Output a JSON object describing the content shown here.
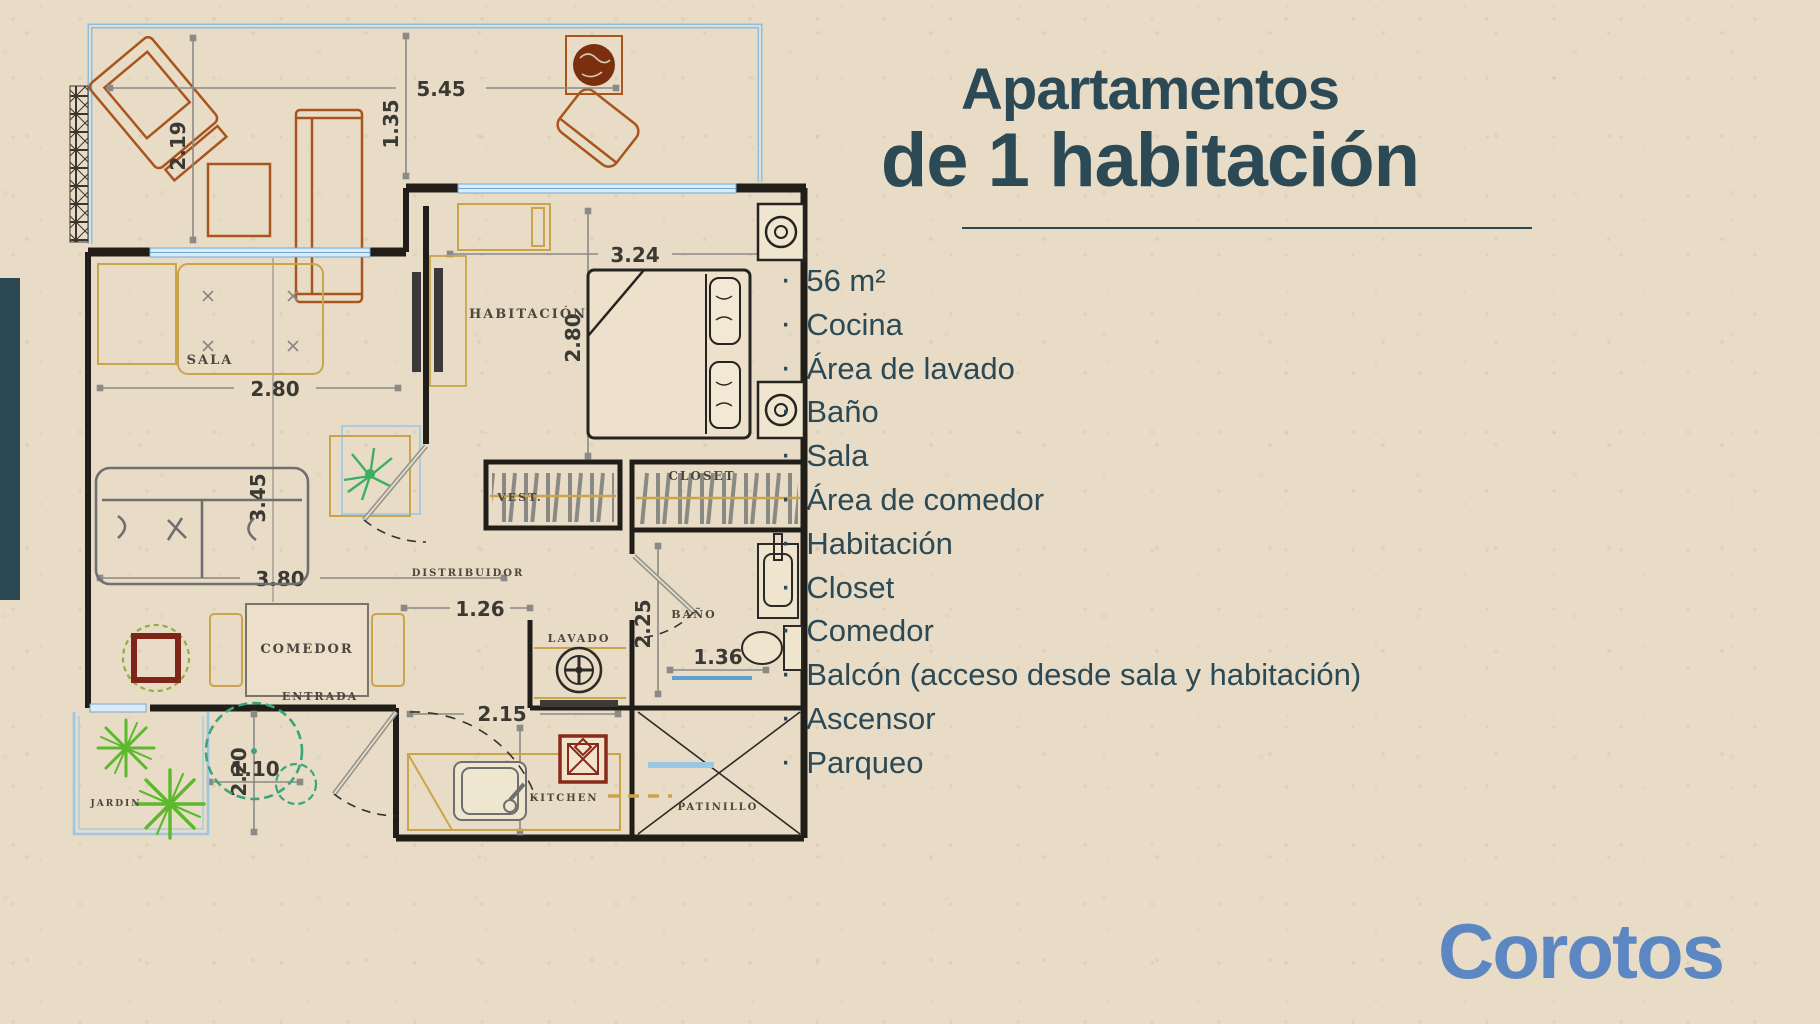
{
  "title": {
    "line1": "Apartamentos",
    "line2": "de 1 habitación"
  },
  "features": {
    "bullet": "·",
    "items": [
      "56 m²",
      "Cocina",
      "Área de lavado",
      "Baño",
      "Sala",
      "Área de comedor",
      "Habitación",
      "Closet",
      "Comedor",
      "Balcón (acceso desde sala y habitación)",
      "Ascensor",
      "Parqueo"
    ]
  },
  "brand": {
    "name": "Corotos",
    "color": "#5c87c2"
  },
  "floor_plan": {
    "rooms": [
      {
        "label": "SALA"
      },
      {
        "label": "HABITACIÓN"
      },
      {
        "label": "VEST."
      },
      {
        "label": "CLOSET"
      },
      {
        "label": "COMEDOR"
      },
      {
        "label": "DISTRIBUIDOR"
      },
      {
        "label": "LAVADO"
      },
      {
        "label": "BAÑO"
      },
      {
        "label": "ENTRADA"
      },
      {
        "label": "KITCHEN"
      },
      {
        "label": "PATINILLO"
      },
      {
        "label": "JARDIN"
      }
    ],
    "dimensions": [
      "5.45",
      "1.35",
      "2.19",
      "3.24",
      "2.80",
      "2.80",
      "3.45",
      "3.80",
      "1.26",
      "2.20",
      "1.10",
      "2.15",
      "1.15",
      "2.25",
      "1.36"
    ],
    "colors": {
      "walls": "#211e1a",
      "glass": "#7fb3d9",
      "dimension_lines": "#8a8a86",
      "furniture_orange": "#a8561e",
      "furniture_yellow": "#c9a44b",
      "plant_green": "#3aa678",
      "palm_green": "#5cb92d",
      "stove_red": "#8a2a1a",
      "accent_dark": "#2c4956"
    }
  }
}
